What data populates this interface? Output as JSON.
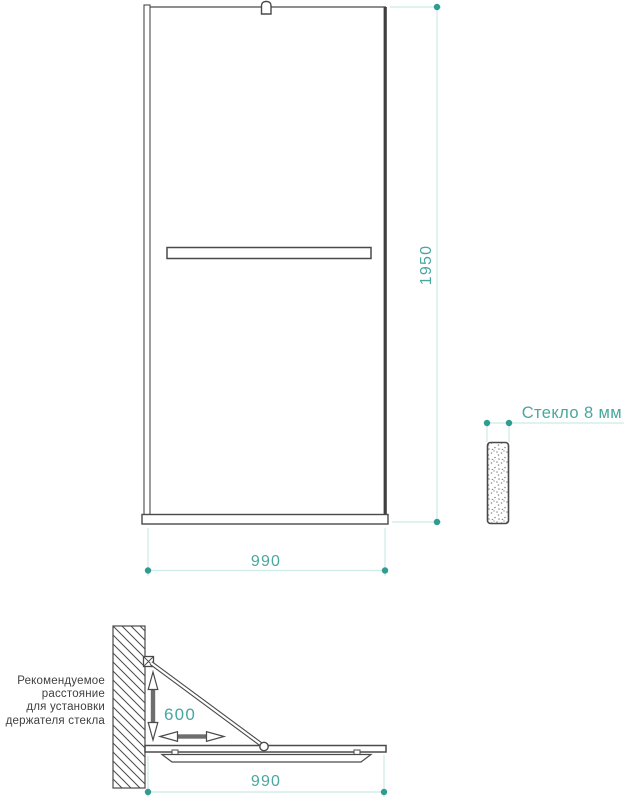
{
  "front_view": {
    "height_dim": "1950",
    "width_dim": "990"
  },
  "section_view": {
    "glass_thickness_label": "Стекло 8 мм"
  },
  "plan_view": {
    "width_dim": "990",
    "holder_distance_dim": "600",
    "note_lines": [
      "Рекомендуемое",
      "расстояние",
      "для установки",
      "держателя стекла"
    ]
  },
  "colors": {
    "dimension_text": "#48A79F",
    "dimension_line": "#CDEAE7",
    "dimension_dot": "#2F9C92",
    "drawing_line": "#4A4A4A",
    "note_text": "#3F3F3F"
  }
}
